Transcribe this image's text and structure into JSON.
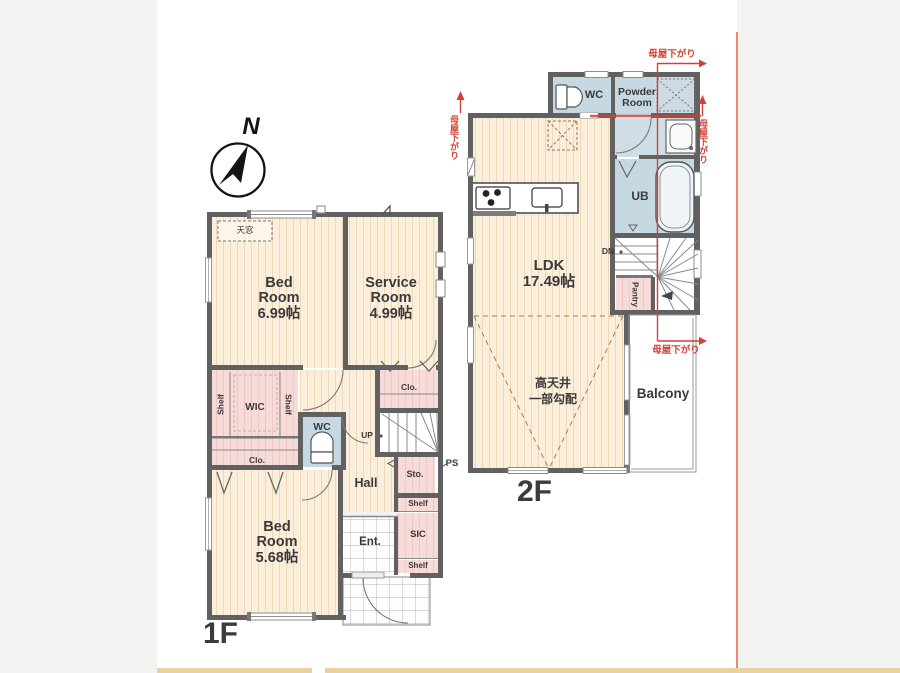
{
  "compass": {
    "north": "N"
  },
  "floor1": {
    "floor_label": "1F",
    "skylight": "天窓",
    "bedroom1": {
      "name_line1": "Bed",
      "name_line2": "Room",
      "size": "6.99帖"
    },
    "service_room": {
      "name_line1": "Service",
      "name_line2": "Room",
      "size": "4.99帖"
    },
    "bedroom2": {
      "name_line1": "Bed",
      "name_line2": "Room",
      "size": "5.68帖"
    },
    "wic": "WIC",
    "shelf_left": "Shelf",
    "shelf_right": "Shelf",
    "closet_left": "Clo.",
    "closet_right": "Clo.",
    "wc": "WC",
    "hall": "Hall",
    "up": "UP",
    "storage": "Sto.",
    "pipe_space": "PS",
    "shelf_upper": "Shelf",
    "sic": "SIC",
    "shelf_lower": "Shelf",
    "entrance": "Ent."
  },
  "floor2": {
    "floor_label": "2F",
    "wc": "WC",
    "powder_room": "Powder Room",
    "unit_bath": "UB",
    "down": "DN",
    "pantry": "Pantry",
    "ldk": {
      "name": "LDK",
      "size": "17.49帖"
    },
    "high_ceiling_line1": "高天井",
    "high_ceiling_line2": "一部勾配",
    "balcony": "Balcony"
  },
  "annotations": {
    "roof_lowering": "母屋下がり"
  },
  "colors": {
    "wall": "#616161",
    "wood_floor": "#fbeeda",
    "closet_pink": "#f6dbd8",
    "wet_blue": "#c6d9e3",
    "annotation_red": "#d04136",
    "edge_orange": "#e2643f",
    "edge_tan": "#e9d2a2",
    "label_dark": "#3a3a3a"
  }
}
